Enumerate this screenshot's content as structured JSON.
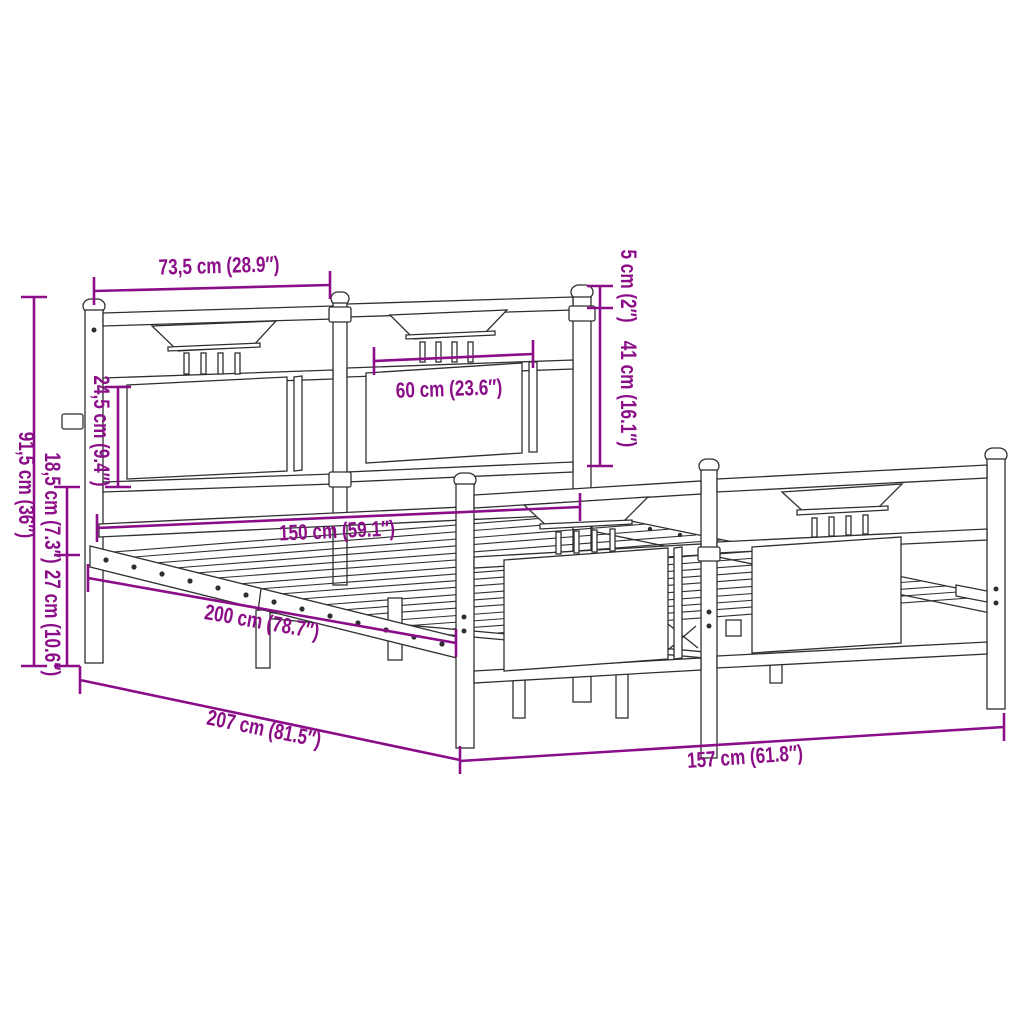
{
  "page": {
    "background": "#ffffff",
    "description": "Technical dimension drawing of a metal bed frame with headboard and footboard, shown in perspective with purple measurement annotations"
  },
  "colors": {
    "dimension_accent": "#8B0E88",
    "line_ink": "#2F2F2F",
    "background": "#ffffff"
  },
  "diagram": {
    "type": "product-dimension-drawing",
    "subject": "metal bed frame without mattress",
    "dimensions": [
      {
        "id": "headboard-section-width",
        "label": "73,5 cm (28.9″)",
        "cm": 73.5,
        "inches": 28.9
      },
      {
        "id": "post-top-to-rail",
        "label": "5 cm (2″)",
        "cm": 5,
        "inches": 2
      },
      {
        "id": "headboard-above-base",
        "label": "41 cm (16.1″)",
        "cm": 41,
        "inches": 16.1
      },
      {
        "id": "headboard-panel-height",
        "label": "24,5 cm (9.4″)",
        "cm": 24.5,
        "inches": 9.4
      },
      {
        "id": "panel-width",
        "label": "60 cm (23.6″)",
        "cm": 60,
        "inches": 23.6
      },
      {
        "id": "mattress-width",
        "label": "150 cm (59.1″)",
        "cm": 150,
        "inches": 59.1
      },
      {
        "id": "total-height",
        "label": "91,5 cm (36″)",
        "cm": 91.5,
        "inches": 36
      },
      {
        "id": "rail-section-height",
        "label": "18,5 cm (7.3″)",
        "cm": 18.5,
        "inches": 7.3
      },
      {
        "id": "under-bed-clearance",
        "label": "27 cm (10.6″)",
        "cm": 27,
        "inches": 10.6
      },
      {
        "id": "mattress-length",
        "label": "200 cm (78.7″)",
        "cm": 200,
        "inches": 78.7
      },
      {
        "id": "total-length",
        "label": "207 cm (81.5″)",
        "cm": 207,
        "inches": 81.5
      },
      {
        "id": "total-width",
        "label": "157 cm (61.8″)",
        "cm": 157,
        "inches": 61.8
      }
    ]
  }
}
